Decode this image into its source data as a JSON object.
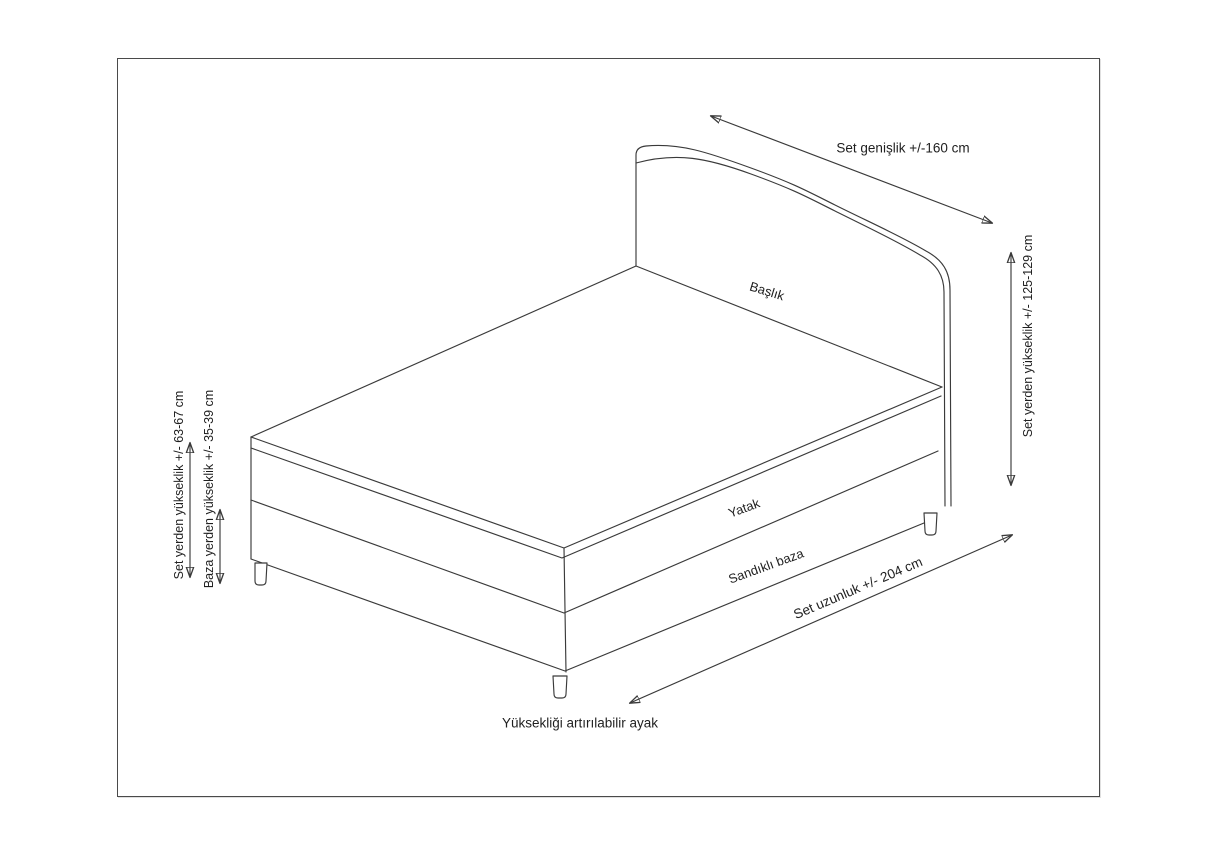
{
  "document": {
    "type": "bed-set-dimension-technical-drawing",
    "background_color": "#ffffff",
    "frame_border_color": "#4a4a4a",
    "line_color": "#3a3a3a",
    "text_color": "#1f1f1f"
  },
  "part_labels": {
    "headboard": "Başlık",
    "mattress": "Yatak",
    "storage_base": "Sandıklı baza",
    "adjustable_foot": "Yüksekliği artırılabilir ayak"
  },
  "dimension_labels": {
    "set_width": "Set genişlik +/-160 cm",
    "set_height_from_floor": "Set yerden yükseklik +/- 125-129 cm",
    "set_top_height_from_floor": "Set yerden yükseklik +/- 63-67 cm",
    "base_height_from_floor": "Baza yerden yükseklik +/- 35-39 cm",
    "set_length": "Set uzunluk +/- 204 cm"
  }
}
